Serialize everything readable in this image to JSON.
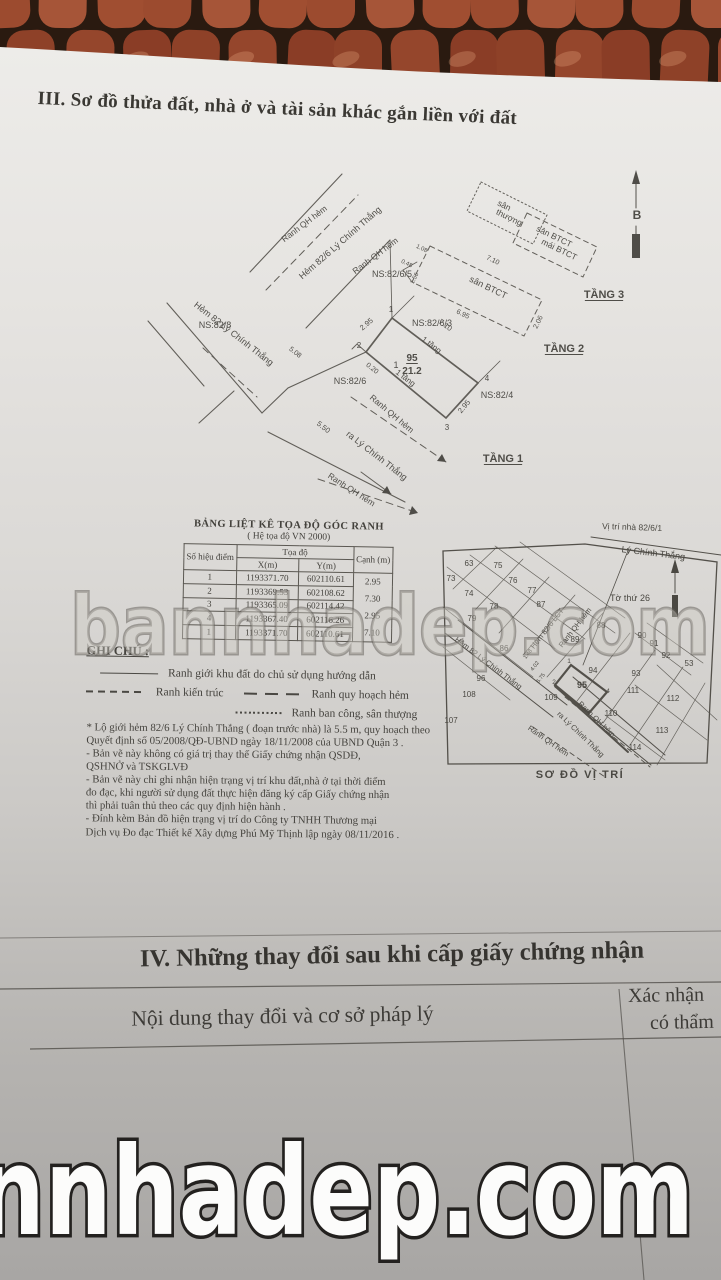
{
  "photo": {
    "watermark_center": "bannhadep.com",
    "watermark_bottom": "nnhadep.com"
  },
  "section_iii": {
    "title": "III. Sơ đồ thửa đất, nhà ở và tài sản khác gắn liền với đất"
  },
  "drawing": {
    "labels": [
      {
        "t": "Ranh QH hẻm",
        "x": 306,
        "y": 86,
        "r": -37,
        "s": 8.5
      },
      {
        "t": "Hẻm 82/6 Lý Chính Thắng",
        "x": 342,
        "y": 105,
        "r": -41,
        "s": 9
      },
      {
        "t": "Ranh QH hẻm",
        "x": 377,
        "y": 118,
        "r": -37,
        "s": 8.5
      },
      {
        "t": "NS:82/8",
        "x": 215,
        "y": 188,
        "s": 9
      },
      {
        "t": "NS:82/6/5",
        "x": 392,
        "y": 137,
        "s": 9
      },
      {
        "t": "NS:82/6/3",
        "x": 432,
        "y": 186,
        "s": 9
      },
      {
        "t": "NS:82/6",
        "x": 350,
        "y": 244,
        "s": 9
      },
      {
        "t": "NS:82/4",
        "x": 497,
        "y": 258,
        "s": 9
      },
      {
        "t": "Hẻm 82 Lý Chính Thắng",
        "x": 232,
        "y": 196,
        "r": 38,
        "s": 9
      },
      {
        "t": "Ranh QH hẻm",
        "x": 390,
        "y": 276,
        "r": 40,
        "s": 8.5
      },
      {
        "t": "ra Lý Chính Thắng",
        "x": 375,
        "y": 318,
        "r": 38,
        "s": 9
      },
      {
        "t": "Ranh QH hẻm",
        "x": 350,
        "y": 352,
        "r": 33,
        "s": 8.5
      },
      {
        "t": "5.50",
        "x": 322,
        "y": 289,
        "r": 38,
        "s": 7.5
      },
      {
        "t": "5.08",
        "x": 294,
        "y": 214,
        "r": 38,
        "s": 7
      },
      {
        "t": "0.20",
        "x": 371,
        "y": 230,
        "r": 38,
        "s": 7
      },
      {
        "t": "2.95",
        "x": 368,
        "y": 186,
        "r": -40,
        "s": 7.5
      },
      {
        "t": "7.10",
        "x": 444,
        "y": 187,
        "r": 37,
        "s": 7.5
      },
      {
        "t": "1 tầng",
        "x": 430,
        "y": 207,
        "r": 37,
        "s": 8
      },
      {
        "t": "1 tầng",
        "x": 404,
        "y": 240,
        "r": 37,
        "s": 8
      },
      {
        "t": "2.95",
        "x": 466,
        "y": 268,
        "r": -50,
        "s": 7.5
      },
      {
        "t": "1",
        "x": 391,
        "y": 172,
        "s": 8
      },
      {
        "t": "2",
        "x": 359,
        "y": 208,
        "s": 8
      },
      {
        "t": "3",
        "x": 447,
        "y": 290,
        "s": 8
      },
      {
        "t": "4",
        "x": 487,
        "y": 241,
        "s": 8
      },
      {
        "t": "95",
        "x": 412,
        "y": 221,
        "s": 10,
        "b": 1,
        "u": 1
      },
      {
        "t": "21.2",
        "x": 412,
        "y": 234,
        "s": 10,
        "b": 1
      },
      {
        "t": "1",
        "x": 396,
        "y": 228,
        "s": 9
      },
      {
        "t": "sân BTCT",
        "x": 487,
        "y": 150,
        "r": 26,
        "s": 9
      },
      {
        "t": "7.10",
        "x": 492,
        "y": 122,
        "r": 26,
        "s": 7
      },
      {
        "t": "6.95",
        "x": 462,
        "y": 176,
        "r": 26,
        "s": 7
      },
      {
        "t": "2.06",
        "x": 540,
        "y": 183,
        "r": -64,
        "s": 7
      },
      {
        "t": "1.08",
        "x": 421,
        "y": 110,
        "r": 26,
        "s": 6
      },
      {
        "t": "0.48",
        "x": 406,
        "y": 125,
        "r": 26,
        "s": 6
      },
      {
        "t": "1.56",
        "x": 416,
        "y": 139,
        "r": -64,
        "s": 6
      },
      {
        "t": "TẦNG 2",
        "x": 564,
        "y": 212,
        "s": 11,
        "b": 1,
        "u": 1
      },
      {
        "t": "sân",
        "x": 503,
        "y": 68,
        "r": 26,
        "s": 8.5
      },
      {
        "t": "thượng",
        "x": 508,
        "y": 80,
        "r": 26,
        "s": 8.5
      },
      {
        "t": "sân BTCT",
        "x": 553,
        "y": 99,
        "r": 26,
        "s": 8.5
      },
      {
        "t": "mái BTCT",
        "x": 558,
        "y": 112,
        "r": 26,
        "s": 8.5
      },
      {
        "t": "TẦNG 3",
        "x": 604,
        "y": 158,
        "s": 11,
        "b": 1,
        "u": 1
      },
      {
        "t": "B",
        "x": 637,
        "y": 79,
        "s": 12,
        "b": 1
      },
      {
        "t": "TẦNG 1",
        "x": 503,
        "y": 322,
        "s": 11,
        "b": 1,
        "u": 1
      }
    ]
  },
  "coord_table": {
    "title": "BẢNG LIỆT KÊ TỌA ĐỘ GÓC RANH",
    "subtitle": "( Hệ tọa độ VN 2000)",
    "headers": {
      "point": "Số hiệu điểm",
      "coord": "Tọa độ",
      "x": "X(m)",
      "y": "Y(m)",
      "edge": "Cạnh (m)"
    },
    "rows": [
      {
        "point": "1",
        "x": "1193371.70",
        "y": "602110.61"
      },
      {
        "point": "2",
        "x": "1193369.53",
        "y": "602108.62"
      },
      {
        "point": "3",
        "x": "1193365.09",
        "y": "602114.42"
      },
      {
        "point": "4",
        "x": "1193367.40",
        "y": "602116.26"
      },
      {
        "point": "1",
        "x": "1193371.70",
        "y": "602110.61"
      }
    ],
    "edges": [
      "2.95",
      "7.30",
      "2.95",
      "7.10"
    ]
  },
  "legend": {
    "title": "GHI CHÚ :",
    "items": [
      {
        "style": "solid",
        "label": "Ranh giới khu đất do chủ sử dụng hướng dẫn"
      },
      {
        "style": "dash-small",
        "label": "Ranh kiến trúc"
      },
      {
        "style": "dash-long",
        "label": "Ranh quy hoạch hẻm"
      },
      {
        "style": "dotted",
        "label": "Ranh ban công, sân thượng"
      }
    ]
  },
  "location_map": {
    "pointer_label": "Vị trí nhà 82/6/1",
    "street_label": "Lý Chính Thắng",
    "sheet_label": "Tờ thứ 26",
    "caption": "SƠ ĐỒ VỊ TRÍ",
    "parcels": [
      {
        "n": "63",
        "x": 44,
        "y": 51
      },
      {
        "n": "75",
        "x": 73,
        "y": 53
      },
      {
        "n": "73",
        "x": 26,
        "y": 66
      },
      {
        "n": "74",
        "x": 44,
        "y": 81
      },
      {
        "n": "76",
        "x": 88,
        "y": 68
      },
      {
        "n": "77",
        "x": 107,
        "y": 78
      },
      {
        "n": "78",
        "x": 69,
        "y": 94
      },
      {
        "n": "87",
        "x": 116,
        "y": 92
      },
      {
        "n": "79",
        "x": 47,
        "y": 106
      },
      {
        "n": "88",
        "x": 176,
        "y": 113
      },
      {
        "n": "89",
        "x": 150,
        "y": 127
      },
      {
        "n": "90",
        "x": 217,
        "y": 123
      },
      {
        "n": "91",
        "x": 229,
        "y": 131
      },
      {
        "n": "92",
        "x": 241,
        "y": 143
      },
      {
        "n": "53",
        "x": 264,
        "y": 151
      },
      {
        "n": "86",
        "x": 79,
        "y": 136
      },
      {
        "n": "96",
        "x": 56,
        "y": 166
      },
      {
        "n": "94",
        "x": 168,
        "y": 158
      },
      {
        "n": "95",
        "x": 157,
        "y": 173,
        "b": 1
      },
      {
        "n": "93",
        "x": 211,
        "y": 161
      },
      {
        "n": "111",
        "x": 208,
        "y": 178
      },
      {
        "n": "108",
        "x": 44,
        "y": 182
      },
      {
        "n": "107",
        "x": 26,
        "y": 208
      },
      {
        "n": "109",
        "x": 126,
        "y": 185
      },
      {
        "n": "110",
        "x": 186,
        "y": 201
      },
      {
        "n": "112",
        "x": 248,
        "y": 186
      },
      {
        "n": "113",
        "x": 237,
        "y": 218
      },
      {
        "n": "114",
        "x": 210,
        "y": 235
      }
    ],
    "corner_marks": [
      {
        "n": "1",
        "x": 144,
        "y": 148
      },
      {
        "n": "2",
        "x": 129,
        "y": 169
      },
      {
        "n": "3",
        "x": 163,
        "y": 200
      },
      {
        "n": "4",
        "x": 183,
        "y": 178
      }
    ],
    "streets": [
      {
        "t": "Hẻm 82/6 LCT",
        "x": 124,
        "y": 115,
        "r": -52
      },
      {
        "t": "Ranh QH hẻm",
        "x": 152,
        "y": 114,
        "r": -52
      },
      {
        "t": "Hẻm 82 Lý Chính Thắng",
        "x": 62,
        "y": 150,
        "r": 37
      },
      {
        "t": "ra Lý Chính Thắng",
        "x": 154,
        "y": 221,
        "r": 44
      },
      {
        "t": "Ranh QH hẻm",
        "x": 170,
        "y": 206,
        "r": 44
      },
      {
        "t": "Ranh QH hẻm",
        "x": 122,
        "y": 228,
        "r": 35
      },
      {
        "t": "1.48",
        "x": 104,
        "y": 140,
        "r": -52,
        "s": 5.5
      },
      {
        "t": "4.02",
        "x": 111,
        "y": 152,
        "r": -52,
        "s": 5.5
      },
      {
        "t": "6.75",
        "x": 117,
        "y": 164,
        "r": -52,
        "s": 5.5
      }
    ]
  },
  "notes": {
    "lines": [
      "* Lộ giới hẻm 82/6 Lý Chính Thắng ( đoạn trước nhà) là 5.5 m, quy hoạch theo",
      "Quyết định số 05/2008/QĐ-UBND ngày 18/11/2008 của UBND Quận 3 .",
      "- Bản vẽ này không có giá trị thay thế Giấy chứng nhận QSDĐ,",
      "QSHNỞ và TSKGLVĐ",
      "- Bản vẽ này chỉ ghi nhận hiện trạng vị trí khu đất,nhà ở tại thời điểm",
      "đo đạc, khi người sử dụng đất thực hiện đăng ký cấp Giấy chứng nhận",
      "thì phải tuân thủ theo các quy định hiện hành .",
      "- Đính kèm Bản đồ hiện trạng vị trí do Công ty TNHH Thương mại",
      "Dịch vụ Đo đạc Thiết kế Xây dựng Phú Mỹ Thịnh lập ngày 08/11/2016 ."
    ]
  },
  "section_iv": {
    "title": "IV. Những thay đổi sau khi cấp giấy chứng nhận",
    "left_header": "Nội dung thay đổi và cơ sở pháp lý",
    "right_header_line1": "Xác nhận",
    "right_header_line2": "có thẩm"
  },
  "colors": {
    "tile_accent": "#9a4a2f",
    "paper": "#dcdad7",
    "ink": "#45433e"
  }
}
